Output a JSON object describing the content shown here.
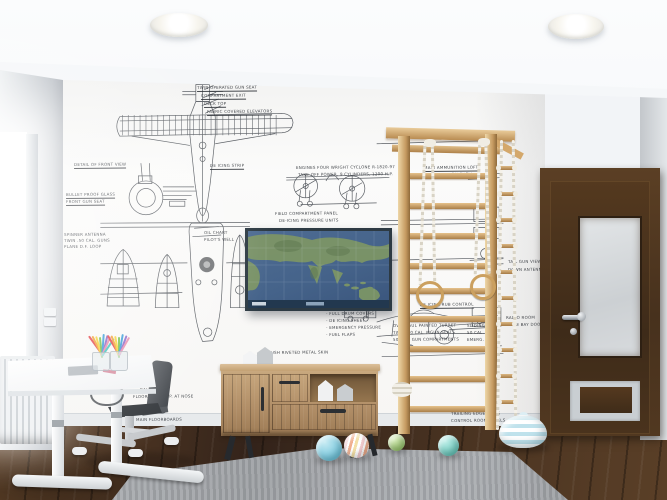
{
  "colors": {
    "floor_wood_dark": "#33231a",
    "floor_wood": "#4c3522",
    "floor_wood_light": "#64452a",
    "rug": "#9b9ea2",
    "wall": "#f7f6f4",
    "left_wall": "#c2c7cc",
    "ceiling": "#f2f4f7",
    "door_wood": "#47311d",
    "dresser_wood": "#b28f68",
    "ladder_wood": "#cfa268",
    "rope": "#eae6da",
    "map_sea": "#45638a",
    "map_land": "#7c9566",
    "map_frame": "#2d3a43",
    "ink": "#3d4249"
  },
  "wallpaper_annotations": [
    {
      "t": "TWIN OPERATED GUN SEAT",
      "x": 197,
      "y": 86,
      "ul": true
    },
    {
      "t": "COMPARTMENT EXIT",
      "x": 201,
      "y": 94,
      "ul": true
    },
    {
      "t": "DECK TOP",
      "x": 204,
      "y": 102,
      "ul": true
    },
    {
      "t": "FABRIC COVERED ELEVATORS",
      "x": 207,
      "y": 110,
      "ul": true
    },
    {
      "t": "DETAIL OF FRONT VIEW",
      "x": 74,
      "y": 163,
      "ul": true
    },
    {
      "t": "DE ICING STRIP",
      "x": 210,
      "y": 164,
      "ul": true
    },
    {
      "t": "ENGINES FOUR WRIGHT CYCLONE R-1820-97",
      "x": 296,
      "y": 166
    },
    {
      "t": "TAKE-OFF POWER, 9 CYLINDERS, 1200 H.P.",
      "x": 298,
      "y": 173
    },
    {
      "t": "BULLET PROOF GLASS",
      "x": 66,
      "y": 193,
      "ul": true
    },
    {
      "t": "FRONT GUN SEAT",
      "x": 66,
      "y": 200,
      "ul": true
    },
    {
      "t": "SPINNER ANTENNA",
      "x": 64,
      "y": 233
    },
    {
      "t": "TWIN .50 CAL. GUNS",
      "x": 64,
      "y": 239
    },
    {
      "t": "PLANE D.F. LOOP",
      "x": 64,
      "y": 245
    },
    {
      "t": "OIL CHART",
      "x": 204,
      "y": 231
    },
    {
      "t": "PILOT'S WELL",
      "x": 204,
      "y": 238
    },
    {
      "t": "FIELD COMPARTMENT PANEL",
      "x": 275,
      "y": 212
    },
    {
      "t": "DE-ICING PRESSURE UNITS",
      "x": 279,
      "y": 219
    },
    {
      "t": "MAIN AMMUNITION LOFT",
      "x": 424,
      "y": 166,
      "ul": true
    },
    {
      "t": "AMMUNITION SHELL",
      "x": 429,
      "y": 173
    },
    {
      "t": "DE ICING RUB CONTROL",
      "x": 420,
      "y": 303,
      "ul": true
    },
    {
      "t": "- FULL DRUM COVERS",
      "x": 326,
      "y": 312
    },
    {
      "t": "- DE ICING SHEET",
      "x": 326,
      "y": 319
    },
    {
      "t": "- EMERGENCY PRESSURE",
      "x": 326,
      "y": 326
    },
    {
      "t": "- FUEL FLAPS",
      "x": 326,
      "y": 333
    },
    {
      "t": "FLUSH RIVETED METAL SKIN",
      "x": 266,
      "y": 351
    },
    {
      "t": "OVERHAUL PAINTED TURRET",
      "x": 393,
      "y": 324
    },
    {
      "t": "TWIN .50 CAL. MGUN SEATS",
      "x": 393,
      "y": 331
    },
    {
      "t": "50 CAL. GUN COMPARTMENTS",
      "x": 393,
      "y": 338
    },
    {
      "t": "SLIDING DOOR",
      "x": 467,
      "y": 324
    },
    {
      "t": "50 CAL. GUN",
      "x": 467,
      "y": 331
    },
    {
      "t": "EMERG. EXIT",
      "x": 467,
      "y": 338
    },
    {
      "t": "BALANCED",
      "x": 140,
      "y": 388
    },
    {
      "t": "FLOORBOARD A.P. AT NOSE",
      "x": 133,
      "y": 395
    },
    {
      "t": "MAIN FLOORBOARDS",
      "x": 136,
      "y": 418
    },
    {
      "t": "TRAILING EDGE FLAPS",
      "x": 451,
      "y": 412
    },
    {
      "t": "CONTROL ROOM PANELS",
      "x": 451,
      "y": 419
    },
    {
      "t": "TAIL GUN VIEW",
      "x": 508,
      "y": 260
    },
    {
      "t": "DOWN ANTENNA",
      "x": 508,
      "y": 268
    },
    {
      "t": "RADIO ROOM",
      "x": 506,
      "y": 316
    },
    {
      "t": "BOMB BAY DOORS",
      "x": 506,
      "y": 323
    }
  ],
  "balls": [
    {
      "name": "ball-blue",
      "x": 316,
      "y": 435,
      "d": 26,
      "c1": "#c7ebf3",
      "c2": "#6fc3da"
    },
    {
      "name": "ball-striped",
      "x": 344,
      "y": 433,
      "d": 25,
      "striped": [
        "#f4cdd0",
        "#f0ae8d",
        "#f3e0a8"
      ]
    },
    {
      "name": "ball-green",
      "x": 388,
      "y": 434,
      "d": 17,
      "c1": "#d9edbd",
      "c2": "#99c56e"
    },
    {
      "name": "ball-teal",
      "x": 438,
      "y": 435,
      "d": 21,
      "c1": "#c0efe9",
      "c2": "#68c6ba"
    }
  ],
  "pencil_colors": [
    "#e5484d",
    "#f2a43a",
    "#f5d43e",
    "#7bc24f",
    "#3f9fd8",
    "#8f6bc9",
    "#e88fb0",
    "#45c8c0"
  ],
  "pouf": {
    "stripe_light": "#ffffff",
    "stripe_blue": "#bfe2ec"
  }
}
